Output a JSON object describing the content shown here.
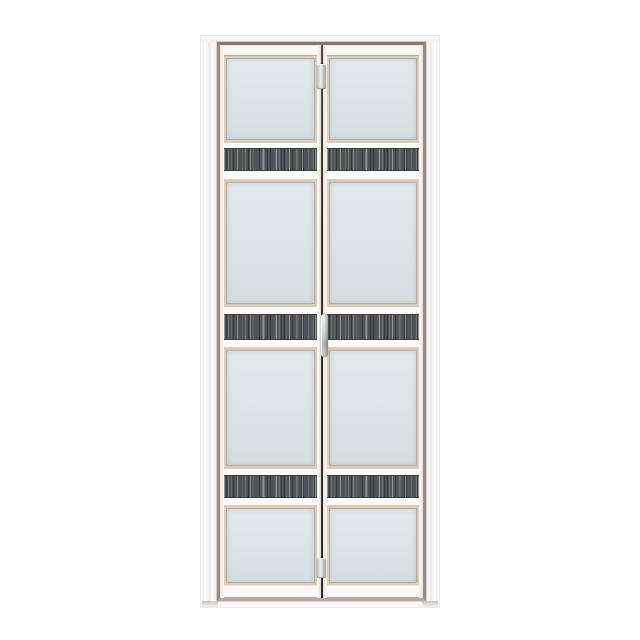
{
  "scene": {
    "description": "Product photo of a white aluminium bi-fold bathroom door with four frosted glass panes per leaf and three dark woodgrain accent bands, centered on a plain white background",
    "object": "bi-fold-door",
    "leaf_count": 2,
    "accent_band_count": 3,
    "glass_panes_per_leaf": 4,
    "hardware": [
      "top-pivot-hinge",
      "flush-pull-handle",
      "bottom-pivot-hinge"
    ]
  },
  "door": {
    "panel_ids": [
      "left",
      "right"
    ],
    "sections": [
      {
        "type": "rail",
        "h": 11
      },
      {
        "type": "glass",
        "h": 87
      },
      {
        "type": "band",
        "rail_top": 5,
        "strip": 23,
        "rail_bottom": 8
      },
      {
        "type": "glass",
        "h": 130
      },
      {
        "type": "band",
        "rail_top": 7,
        "strip": 26,
        "rail_bottom": 7
      },
      {
        "type": "glass",
        "h": 123
      },
      {
        "type": "band",
        "rail_top": 6,
        "strip": 23,
        "rail_bottom": 7
      },
      {
        "type": "glass",
        "h": 80
      },
      {
        "type": "rail",
        "h": 13
      }
    ],
    "colors": {
      "background": "#ffffff",
      "frame_white": "#faf9f8",
      "reveal_taupe": "#9a8c83",
      "reveal_dark": "#857870",
      "panel_white": "#f7f5f2",
      "bead": "#d7cdbf",
      "bead_line": "#b7ab99",
      "glass_light": "#e3e9ed",
      "glass_dark": "#d7dee2",
      "strip_base": "#4f5456",
      "gap_dark": "#3b332d",
      "metal_light": "#f1f3f2",
      "metal_dark": "#a2a6a5",
      "shadow": "#c9c6c2"
    }
  }
}
